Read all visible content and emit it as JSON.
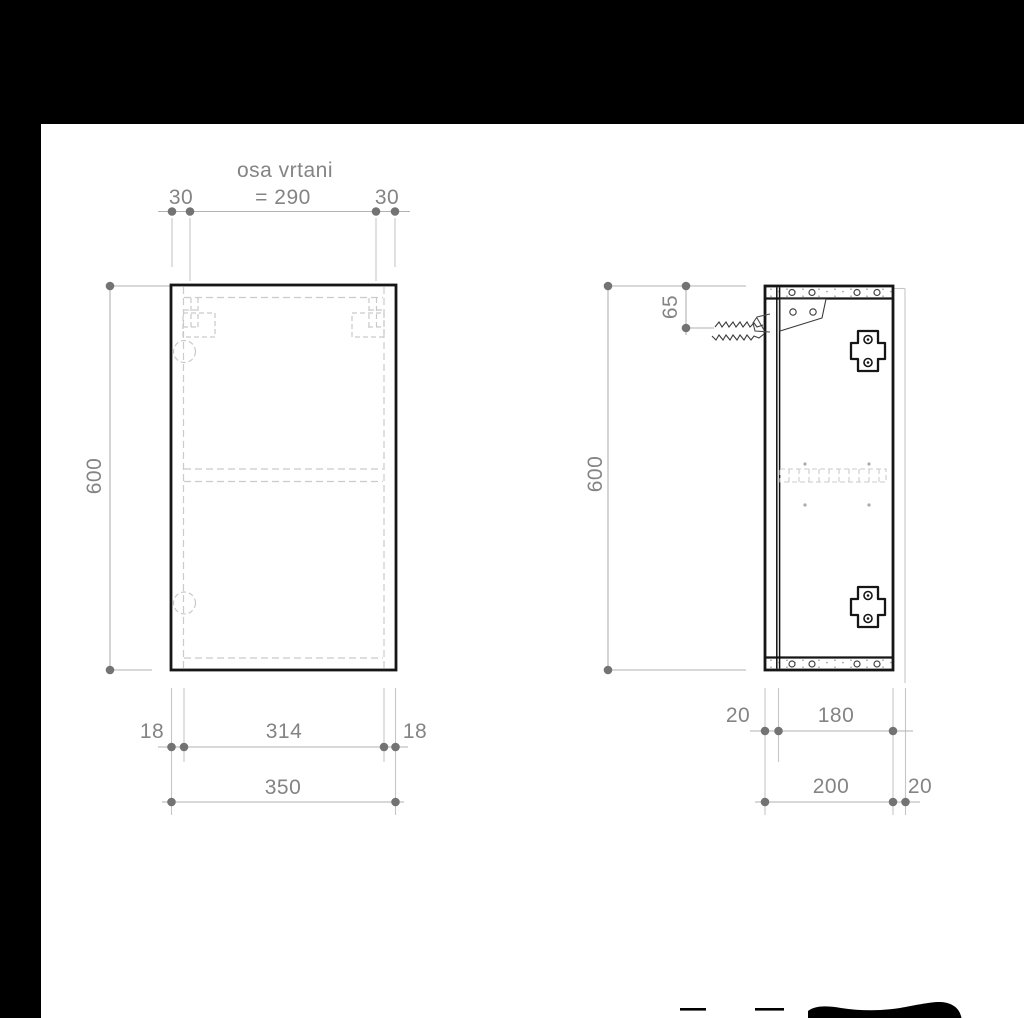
{
  "drawing_title": "osa vrtani",
  "colors": {
    "background": "#000000",
    "paper": "#ffffff",
    "outline_black": "#161616",
    "dimension_grey": "#848484",
    "dimension_line_grey": "#b2b2b2",
    "hidden_line_grey": "#cbcbcb"
  },
  "front_view": {
    "drill_axis_label": "osa vrtani",
    "drill_axis_spacing": "= 290",
    "drill_offset_left": "30",
    "drill_offset_right": "30",
    "height": "600",
    "panel_left": "18",
    "inner_width": "314",
    "panel_right": "18",
    "total_width": "350"
  },
  "side_view": {
    "height": "600",
    "screw_axis_offset": "65",
    "front_offset": "20",
    "inner_depth": "180",
    "total_depth": "200",
    "back_offset": "20"
  }
}
